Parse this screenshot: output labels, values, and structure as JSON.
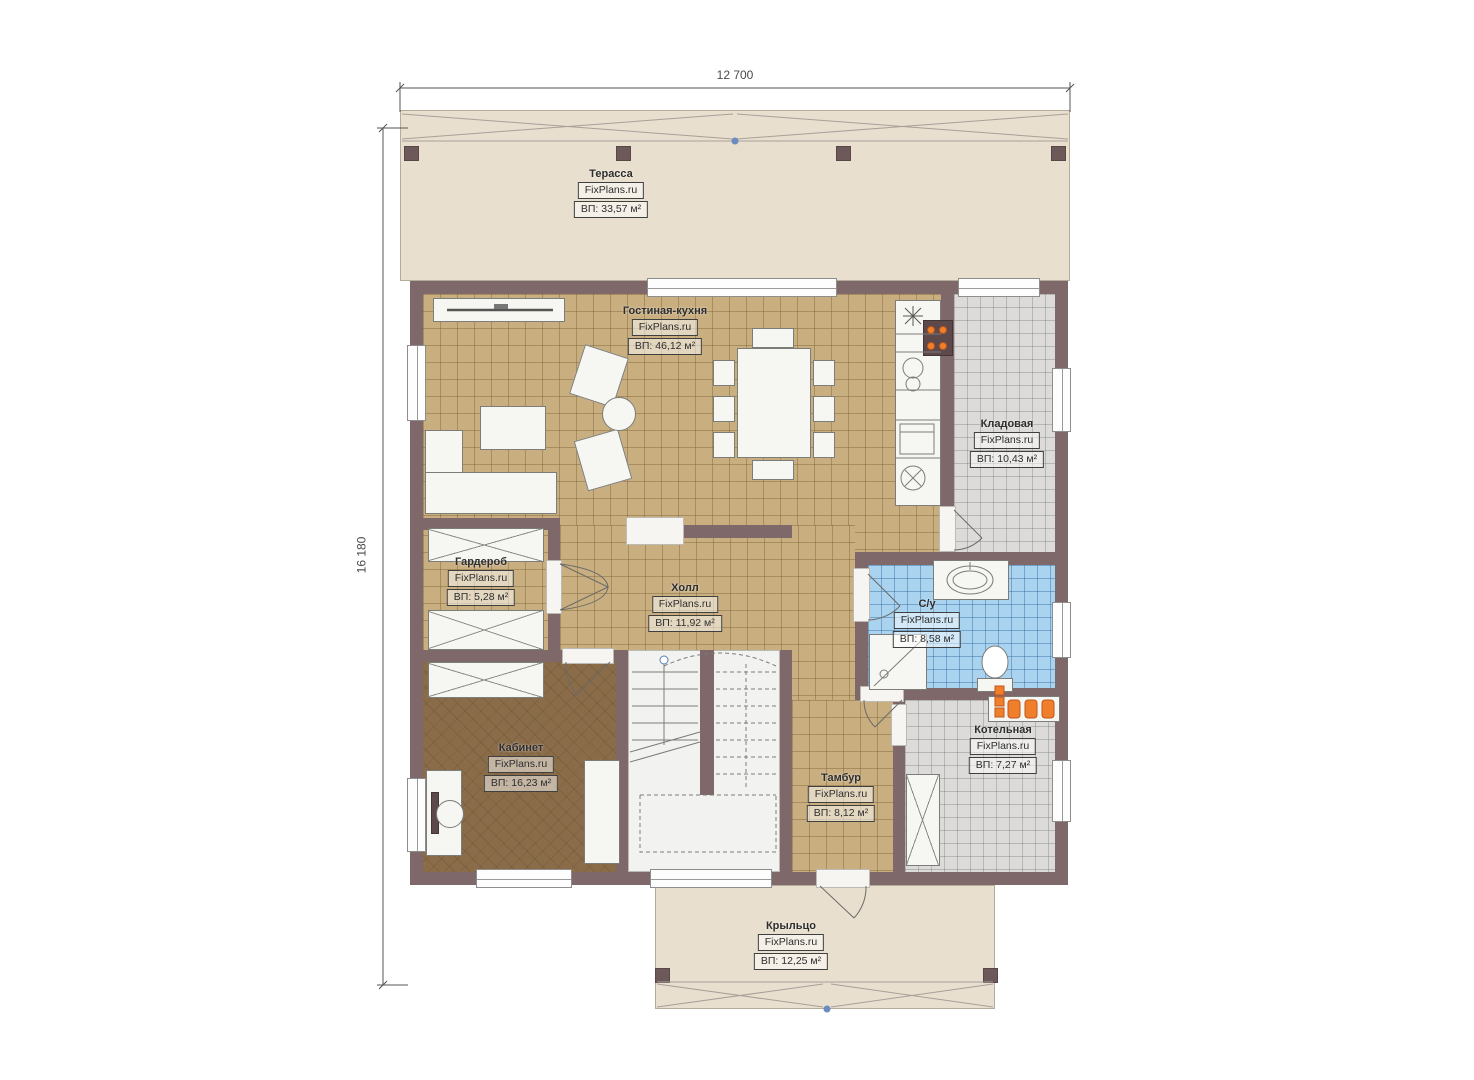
{
  "brand": "FixPlans.ru",
  "dimensions": {
    "width": "12 700",
    "height": "16 180"
  },
  "rooms": {
    "terrace": {
      "name": "Терасса",
      "area": "ВП: 33,57 м²"
    },
    "living_kitchen": {
      "name": "Гостиная-кухня",
      "area": "ВП: 46,12 м²"
    },
    "storage": {
      "name": "Кладовая",
      "area": "ВП: 10,43 м²"
    },
    "wardrobe": {
      "name": "Гардероб",
      "area": "ВП: 5,28 м²"
    },
    "hall": {
      "name": "Холл",
      "area": "ВП: 11,92 м²"
    },
    "bathroom": {
      "name": "С/у",
      "area": "ВП: 8,58 м²"
    },
    "office": {
      "name": "Кабинет",
      "area": "ВП: 16,23 м²"
    },
    "vestibule": {
      "name": "Тамбур",
      "area": "ВП: 8,12 м²"
    },
    "boiler": {
      "name": "Котельная",
      "area": "ВП: 7,27 м²"
    },
    "porch": {
      "name": "Крыльцо",
      "area": "ВП: 12,25 м²"
    }
  },
  "colors": {
    "wall": "#7e686a",
    "floor_tile_tan": "#c9ae80",
    "floor_tile_gray": "#dcdbd9",
    "floor_tile_blue": "#a9d3ef",
    "floor_wood_dark": "#8a6c49",
    "outdoor_beige": "#e9dfce",
    "equipment_orange": "#ef7f2a",
    "marker_blue": "#6b8cbf"
  }
}
